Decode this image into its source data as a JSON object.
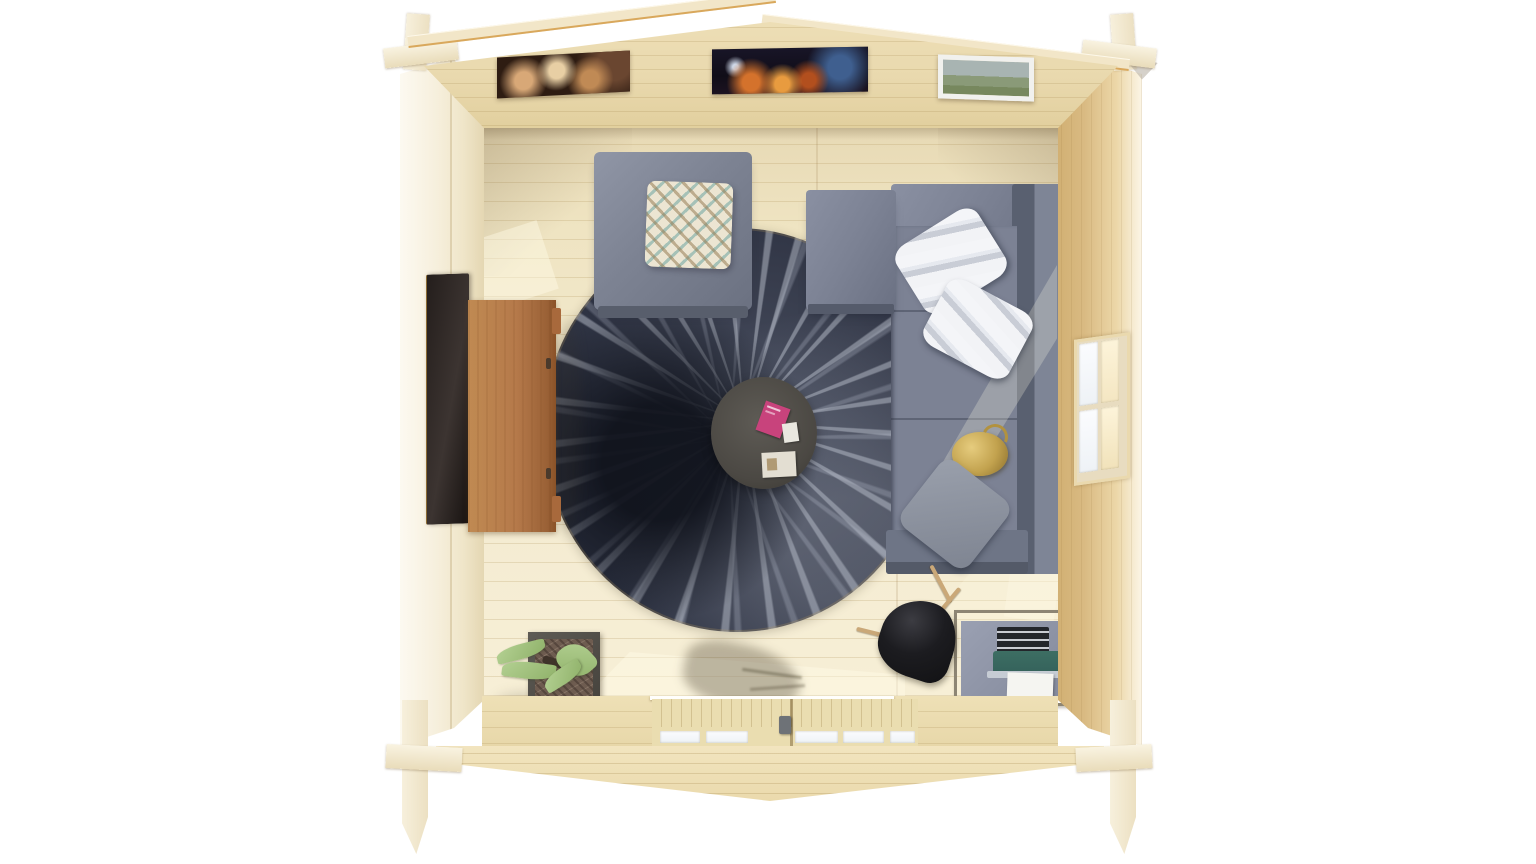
{
  "scene": {
    "type": "3d architectural render",
    "view": "top-down interior of a timber log cabin garden room with the roof removed",
    "background": "white"
  },
  "palette": {
    "fascia": "#f2e6c8",
    "gableWall": "#e9d9ae",
    "floor": "#f3ead0",
    "rightWall": "#d9ba82",
    "rug": "#2b3040",
    "rugStreak": "#aab0bd",
    "sofa": "#7c8294",
    "ottoman": "#7d8393",
    "wood": "#b5794a",
    "tv": "#241e1c",
    "tableTop": "#4b4843",
    "bookPink": "#c8437c",
    "gold": "#c2a24e",
    "typewriterTeal": "#33605a",
    "lampBlack": "#121214",
    "leafGreen": "#9fc184",
    "glassPane": "#f7f9fb"
  },
  "objects": {
    "cabin": "Log cabin shell with interlocking corner joints",
    "gableWall": "Rear gable wall with three framed pictures",
    "pictureLeft": "Framed photo with warm blurred bokeh",
    "pictureCenter": "Framed night cityscape photo",
    "pictureRight": "Small white-framed landscape picture",
    "window": "Right wall window with four panes",
    "doors": "Front double doors with glazed panes",
    "floor": "Pale pine plank floor",
    "rug": "Round dark shag rug with radiating light streaks",
    "coffeeTable": "Round charcoal coffee table",
    "pinkBook": "Pink book on table",
    "whiteCard": "Small white card on table",
    "magazine": "Magazine on table",
    "ottoman": "Grey square ottoman",
    "patternCushion": "Cream diamond-pattern cushion",
    "sofa": "Grey L-shaped corner sofa",
    "stripePillows": "Two white striped pillows",
    "greyPillow": "Grey scatter pillow",
    "goldOrnament": "Gold ornament on sofa seat",
    "tv": "Wall-mounted flat TV",
    "sideboard": "Oak media sideboard",
    "planter": "Cube planter with succulent",
    "floorLamp": "Black cone tripod floor lamp",
    "desk": "Metal-framed side desk",
    "typewriter": "Teal vintage typewriter with paper sheet"
  }
}
